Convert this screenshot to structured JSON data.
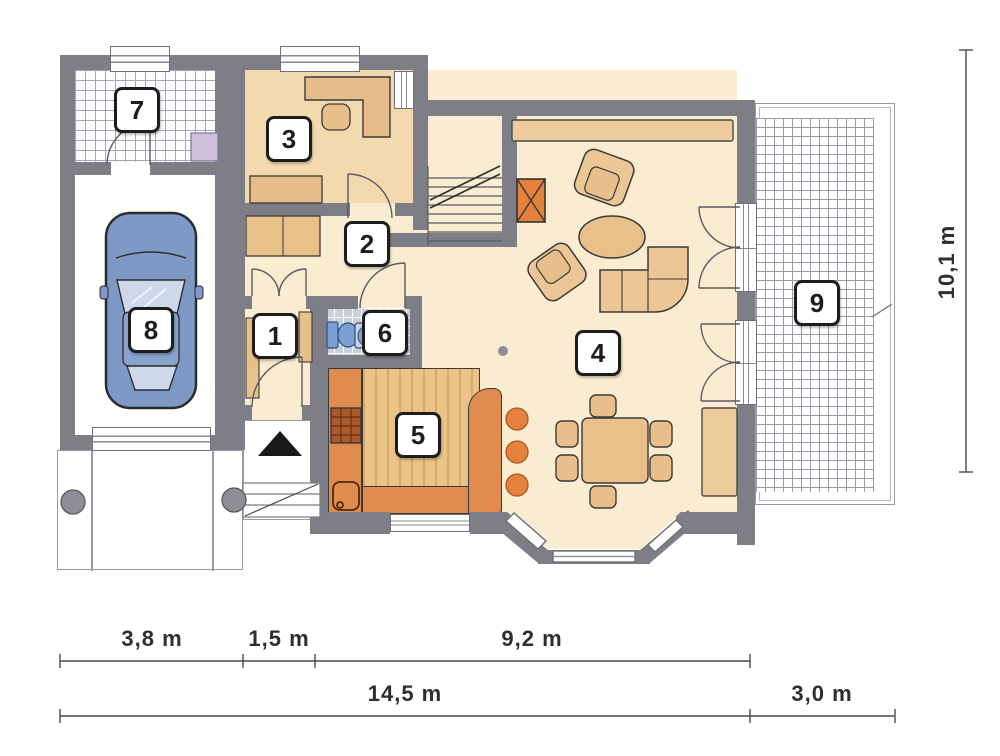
{
  "title": "house-ground-floor-plan",
  "labels": {
    "r1": "1",
    "r2": "2",
    "r3": "3",
    "r4": "4",
    "r5": "5",
    "r6": "6",
    "r7": "7",
    "r8": "8",
    "r9": "9"
  },
  "dimensions": {
    "top": [
      "3,8 m",
      "1,5 m",
      "9,2 m"
    ],
    "bottom": [
      "14,5 m",
      "3,0 m"
    ],
    "right": "10,1 m"
  },
  "icons": {
    "entrance": "entrance-arrow"
  },
  "colors": {
    "wall": "#7e7e86",
    "floor": "#faecd0",
    "study_floor": "#f3d9ae",
    "furniture_tan": "#e8c08a",
    "counter_orange": "#e08b50",
    "accent_orange": "#e2823c",
    "car_blue": "#7e99c5",
    "wc_tile": "#c9cfdb",
    "outline": "#3a3a3a"
  }
}
